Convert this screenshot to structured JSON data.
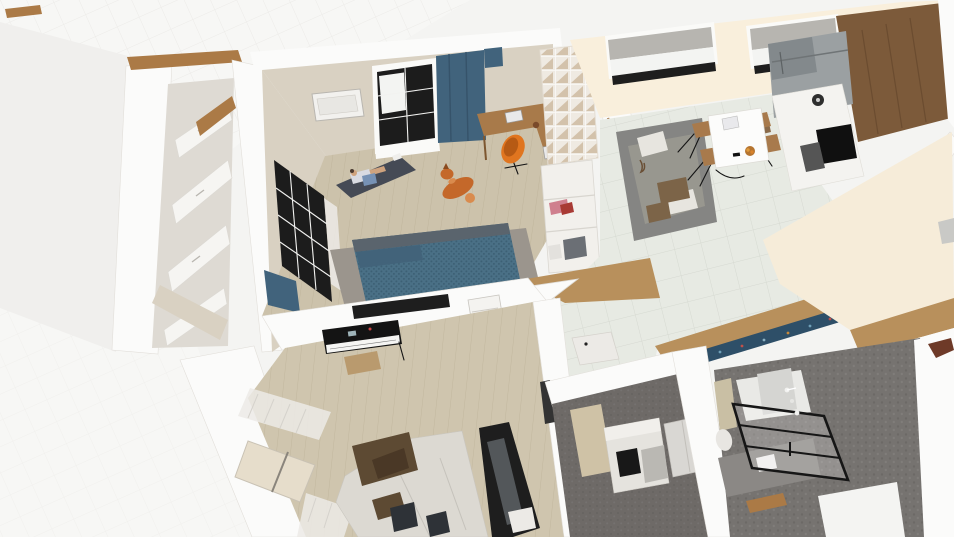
{
  "app": {
    "view_label": "3D floor plan perspective render",
    "no_visible_text": true
  },
  "palette": {
    "bg": "#f4f4f2",
    "bg_tile": "#f7f7f5",
    "ext_plane": "#f0efed",
    "wall_white": "#fbfbfa",
    "wall_edge": "#e2dfda",
    "wall_beige": "#d9d1c2",
    "wall_cream": "#f9efdc",
    "floor_cream": "#f6ecd9",
    "wood_trim": "#ab7a46",
    "floor_wood_bedroom": "#ccc2ab",
    "floor_wood_music": "#cfc5ae",
    "floor_wood_hall": "#b8905c",
    "floor_tile": "#e7eae3",
    "tile_line": "#d6d9d1",
    "closet_inner": "#dedad3",
    "panel_white": "#f6f5f2",
    "window_black": "#1c1c1c",
    "blind_gray": "#b7b5b0",
    "curtain_teal": "#41637c",
    "desk_wood": "#a87a4a",
    "chair_orange": "#e0751f",
    "rug_dark": "#454a55",
    "bed_teal": "#4a7086",
    "bed_knit": "#3d6075",
    "bed_rug": "#9b958d",
    "dog_orange": "#c4682a",
    "sofa_gray": "#858583",
    "sofa_white": "#dcd9d2",
    "blanket_brown": "#5d4a33",
    "piano_black": "#141414",
    "treadmill_black": "#1e1e1e",
    "cabinet_walnut": "#7c5a3a",
    "steel": "#9ba0a2",
    "steel_dark": "#83898c",
    "floor_dark": "#767370",
    "floor_dark2": "#6e6a67",
    "rug_blue": "#2e4f68"
  },
  "scene": {
    "rooms": [
      {
        "name": "bedroom",
        "objects": [
          "back window with black frame",
          "teal curtains",
          "ceiling light panel",
          "L-shaped wood desk",
          "two laptops",
          "mug",
          "orange egg chair",
          "cube shelf",
          "corridor wardrobe",
          "yoga mat with person",
          "shiba dog",
          "teal knit double bed",
          "gray area rug",
          "black framed glass wall",
          "sheer curtain"
        ]
      },
      {
        "name": "closet-hall",
        "objects": [
          "white wardrobe drawers",
          "wood trim"
        ]
      },
      {
        "name": "living-kitchen",
        "objects": [
          "two windows with gray roller blinds",
          "gray corner sofa with pillows",
          "white dining table",
          "four wood-seat wire chairs",
          "fruit bowl",
          "notebook",
          "stainless fridge",
          "walnut cabinets",
          "white counter",
          "black cooktop",
          "oven",
          "coffee maker",
          "cutting boards",
          "tiled floor"
        ]
      },
      {
        "name": "hallway",
        "objects": [
          "tiled floor",
          "caramel wood thresholds",
          "blue patterned runner rug",
          "flat white door panel",
          "empty cream room"
        ]
      },
      {
        "name": "music-room",
        "objects": [
          "wall TV",
          "air conditioner",
          "digital piano keyboard",
          "piano bench",
          "white fabric sofa",
          "brown throw blanket",
          "dark pillows",
          "black treadmill",
          "window with white curtains"
        ]
      },
      {
        "name": "bedroom-2",
        "objects": [
          "dark gray carpet",
          "white bed with black pillow",
          "beige rug",
          "closet panels"
        ]
      },
      {
        "name": "bathroom",
        "objects": [
          "dark pebble floor",
          "black framed shower screen",
          "shower fixtures",
          "toilet",
          "vanity counter",
          "textured accent wall"
        ]
      }
    ]
  }
}
